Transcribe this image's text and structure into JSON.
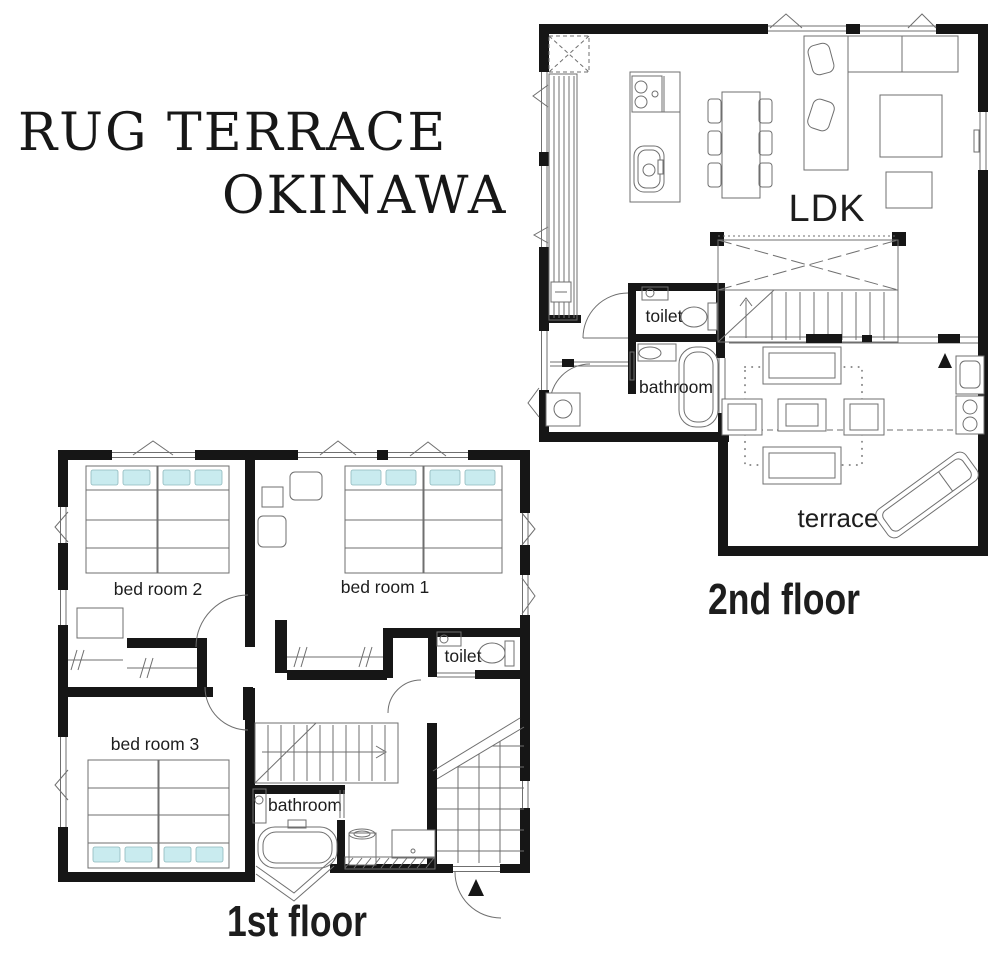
{
  "title": {
    "line1": "RUG TERRACE",
    "line2": "OKINAWA"
  },
  "second_floor": {
    "floor_label": "2nd floor",
    "rooms": {
      "ldk": "LDK",
      "toilet": "toilet",
      "bathroom": "bathroom",
      "terrace": "terrace"
    }
  },
  "first_floor": {
    "floor_label": "1st floor",
    "rooms": {
      "bedroom1": "bed room 1",
      "bedroom2": "bed room 2",
      "bedroom3": "bed room 3",
      "toilet": "toilet",
      "bathroom": "bathroom"
    }
  },
  "colors": {
    "wall": "#161616",
    "thin_line": "#6f6f6f",
    "pillow": "#c9ebef",
    "background": "#ffffff",
    "label": "#1d1d1d"
  }
}
